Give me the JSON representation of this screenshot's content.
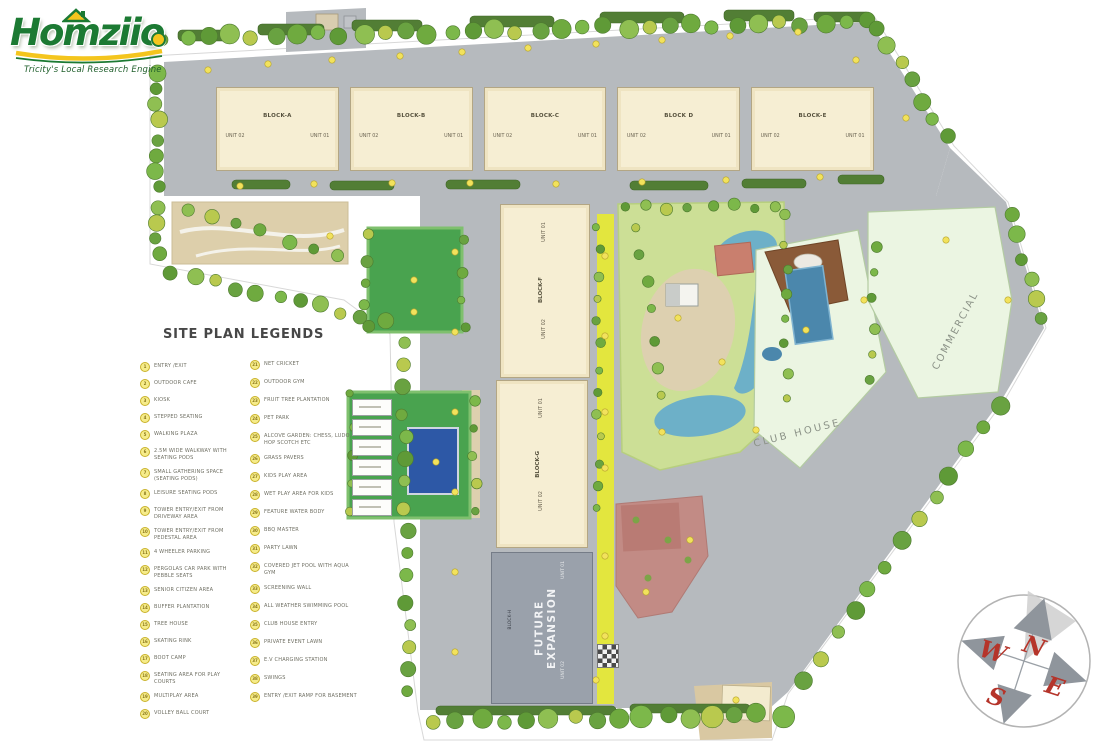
{
  "logo": {
    "brand": "Homziio",
    "tagline": "Tricity's Local Research Engine"
  },
  "legend": {
    "title": "SITE PLAN LEGENDS",
    "col1": [
      {
        "num": "1",
        "label": "ENTRY /EXIT"
      },
      {
        "num": "2",
        "label": "OUTDOOR CAFE"
      },
      {
        "num": "3",
        "label": "KIOSK"
      },
      {
        "num": "4",
        "label": "STEPPED SEATING"
      },
      {
        "num": "5",
        "label": "WALKING PLAZA"
      },
      {
        "num": "6",
        "label": "2.5M WIDE WALKWAY WITH SEATING PODS"
      },
      {
        "num": "7",
        "label": "SMALL GATHERING SPACE (SEATING PODS)"
      },
      {
        "num": "8",
        "label": "LEISURE SEATING PODS"
      },
      {
        "num": "9",
        "label": "TOWER ENTRY/EXIT FROM DRIVEWAY AREA"
      },
      {
        "num": "10",
        "label": "TOWER ENTRY/EXIT FROM PEDESTAL AREA"
      },
      {
        "num": "11",
        "label": "4 WHEELER PARKING"
      },
      {
        "num": "12",
        "label": "PERGOLAS CAR PARK WITH PEBBLE SEATS"
      },
      {
        "num": "13",
        "label": "SENIOR CITIZEN AREA"
      },
      {
        "num": "14",
        "label": "BUFFER PLANTATION"
      },
      {
        "num": "15",
        "label": "TREE HOUSE"
      },
      {
        "num": "16",
        "label": "SKATING RINK"
      },
      {
        "num": "17",
        "label": "BOOT CAMP"
      },
      {
        "num": "18",
        "label": "SEATING AREA FOR PLAY COURTS"
      },
      {
        "num": "19",
        "label": "MULTIPLAY AREA"
      },
      {
        "num": "20",
        "label": "VOLLEY BALL COURT"
      }
    ],
    "col2": [
      {
        "num": "21",
        "label": "NET CRICKET"
      },
      {
        "num": "22",
        "label": "OUTDOOR GYM"
      },
      {
        "num": "23",
        "label": "FRUIT TREE PLANTATION"
      },
      {
        "num": "24",
        "label": "PET PARK"
      },
      {
        "num": "25",
        "label": "ALCOVE GARDEN: CHESS, LUDO, HOP SCOTCH ETC"
      },
      {
        "num": "26",
        "label": "GRASS PAVERS"
      },
      {
        "num": "27",
        "label": "KIDS PLAY AREA"
      },
      {
        "num": "28",
        "label": "WET PLAY AREA FOR KIDS"
      },
      {
        "num": "29",
        "label": "FEATURE WATER BODY"
      },
      {
        "num": "30",
        "label": "BBQ MASTER"
      },
      {
        "num": "31",
        "label": "PARTY LAWN"
      },
      {
        "num": "32",
        "label": "COVERED JET POOL WITH AQUA GYM"
      },
      {
        "num": "33",
        "label": "SCREENING WALL"
      },
      {
        "num": "34",
        "label": "ALL WEATHER SWIMMING POOL"
      },
      {
        "num": "35",
        "label": "CLUB HOUSE ENTRY"
      },
      {
        "num": "36",
        "label": "PRIVATE EVENT LAWN"
      },
      {
        "num": "37",
        "label": "E.V CHARGING STATION"
      },
      {
        "num": "38",
        "label": "SWINGS"
      },
      {
        "num": "39",
        "label": "ENTRY /EXIT RAMP FOR BASEMENT"
      }
    ]
  },
  "plan": {
    "blocks": [
      {
        "name": "BLOCK-A",
        "unit_left": "UNIT 02",
        "unit_right": "UNIT 01"
      },
      {
        "name": "BLOCK-B",
        "unit_left": "UNIT 02",
        "unit_right": "UNIT 01"
      },
      {
        "name": "BLOCK-C",
        "unit_left": "UNIT 02",
        "unit_right": "UNIT 01"
      },
      {
        "name": "BLOCK D",
        "unit_left": "UNIT 02",
        "unit_right": "UNIT 01"
      },
      {
        "name": "BLOCK-E",
        "unit_left": "UNIT 02",
        "unit_right": "UNIT 01"
      }
    ],
    "tower_f": {
      "name": "BLOCK-F",
      "unit_top": "UNIT 01",
      "unit_bottom": "UNIT 02"
    },
    "tower_g": {
      "name": "BLOCK-G",
      "unit_top": "UNIT 01",
      "unit_bottom": "UNIT 02"
    },
    "future": {
      "name": "BLOCK-H",
      "label": "FUTURE EXPANSION",
      "unit_top": "UNIT 01",
      "unit_bottom": "UNIT 02"
    },
    "club_house": "CLUB HOUSE",
    "commercial": "COMMERCIAL"
  },
  "compass": {
    "n": "N",
    "w": "W",
    "e": "E",
    "s": "S"
  },
  "colors": {
    "logo_green": "#1c7a33",
    "logo_yellow": "#f4c51d",
    "road_gray": "#b6babe",
    "building_cream": "#f6eed3",
    "tree_green": "#6faa3f",
    "lawn_green": "#ccdf96",
    "court_green": "#49a34f",
    "pool_blue": "#2d58a6",
    "water_blue": "#6db0c8",
    "clubhouse_mint": "#ebf5e2",
    "future_gray": "#9aa1ab",
    "party_pink": "#c28b85",
    "walkway_yellow": "#e3e63e",
    "sand_beige": "#ddcfab",
    "deck_brown": "#8a5a38",
    "marker_yellow": "#f2e25c",
    "compass_red": "#b5342a"
  }
}
